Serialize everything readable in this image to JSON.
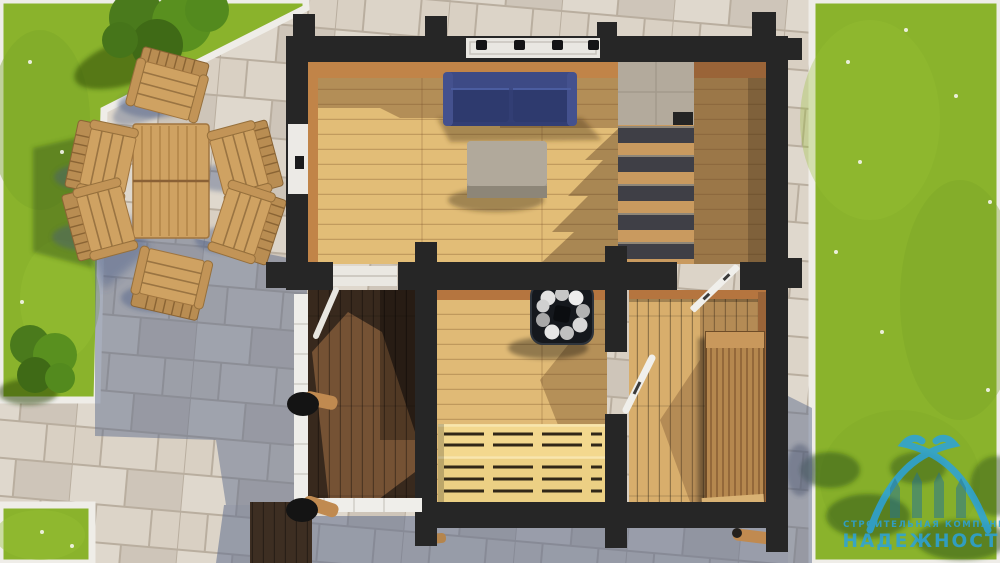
{
  "scene": {
    "title": "Top-down 3D render of a timber sauna house floor plan",
    "areas": {
      "living_room": {
        "label": "living room",
        "items": [
          "blue sofa",
          "gray ottoman",
          "staircase",
          "window"
        ]
      },
      "sauna_room": {
        "label": "sauna",
        "items": [
          "stove with stones",
          "two-tier slatted benches"
        ]
      },
      "rest_room": {
        "label": "rest room",
        "items": [
          "wooden lounger",
          "open doors"
        ]
      },
      "terrace": {
        "label": "terrace",
        "items": [
          "white railing",
          "round log posts",
          "dark decking"
        ]
      },
      "patio": {
        "label": "stone patio",
        "items": [
          "garden table",
          "six garden chairs"
        ]
      },
      "lawn": {
        "label": "lawn",
        "items": [
          "bushes",
          "daisies"
        ]
      }
    }
  },
  "watermark": {
    "tagline": "СТРОИТЕЛЬНАЯ КОМПАНИЯ",
    "brand": "НАДЕЖНОСТЬ"
  },
  "colors": {
    "grass": "#8ab32c",
    "paving": "#d9d0c3",
    "pavingShadow": "#5f7296",
    "wall": "#262626",
    "floorLiving": "#e2bd77",
    "floorSauna": "#e0ba76",
    "floorRest": "#d8ae6c",
    "deck": "#38291d",
    "sofa": "#323e74",
    "ottoman": "#a59d90",
    "stairTread": "#3f3f46",
    "benchWood": "#f3d88e",
    "loungerWood": "#b5874e",
    "railing": "#efeeea",
    "gardenWood": "#cfa262",
    "logoBlue": "#2ba3dd"
  }
}
